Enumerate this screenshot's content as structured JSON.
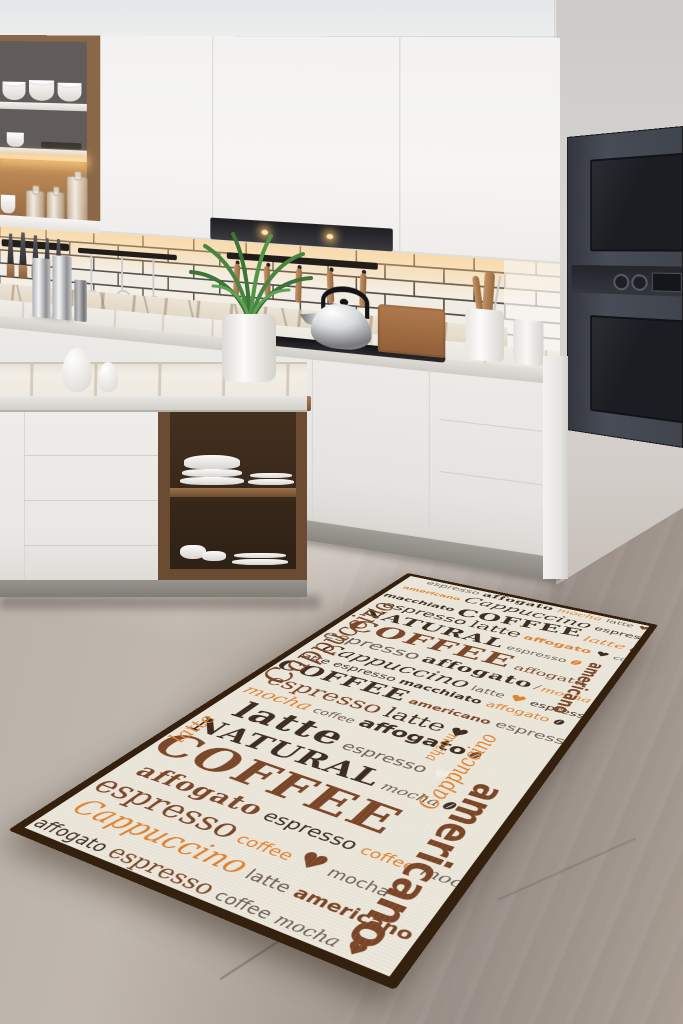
{
  "scene": {
    "type": "kitchen product photo",
    "subject": "coffee-typography kitchen runner rug on concrete floor in modern white kitchen"
  },
  "palette": {
    "wall": "#d5d2cf",
    "cabinet_white": "#f3f2f0",
    "wood": "#8a6747",
    "oven_dark": "#40444d",
    "floor_concrete": "#aaa098",
    "led_glow": "#ffd9a0",
    "rug_bg": "#ece7db",
    "rug_border": "#33200f",
    "rug_dark": "#3a2a1e",
    "rug_brown": "#7a4426",
    "rug_orange": "#e0812f",
    "rug_gray": "#6a5d51",
    "rug_cream": "#f4efe4"
  },
  "rug": {
    "background": "#ece7db",
    "border_color": "#33200f",
    "colors": {
      "d": "#3a2a1e",
      "b": "#7a4426",
      "o": "#e0812f",
      "g": "#6a5d51",
      "w": "#f4efe4"
    },
    "words": [
      "COFFEE",
      "NATURAL",
      "Cappuccino",
      "espresso",
      "latte",
      "mocha",
      "affogato",
      "americano",
      "macchiato",
      "coffee"
    ],
    "icons": {
      "heart": "♥",
      "bean": "coffee-bean-shape"
    },
    "vertical": [
      {
        "w": "Cappuccino",
        "x": -2,
        "y": 96,
        "z": 40,
        "c": "b",
        "f": "f-script",
        "up": true
      },
      {
        "w": "americano",
        "x": 272,
        "y": 128,
        "z": 21,
        "c": "b",
        "f": "f-sansb",
        "up": false
      },
      {
        "w": "mocha",
        "x": 208,
        "y": 338,
        "z": 15,
        "c": "o",
        "f": "f-script",
        "up": false
      },
      {
        "w": "Cappuccino",
        "x": 234,
        "y": 322,
        "z": 22,
        "c": "o",
        "f": "f-script",
        "up": true
      },
      {
        "w": "americano",
        "x": 258,
        "y": 398,
        "z": 36,
        "c": "b",
        "f": "f-sansb",
        "up": false
      },
      {
        "w": "latte",
        "x": 2,
        "y": 420,
        "z": 22,
        "c": "o",
        "f": "f-script",
        "up": true
      }
    ],
    "rows": [
      {
        "pl": 26,
        "t": [
          {
            "w": "espresso",
            "z": 16,
            "c": "g",
            "f": "f-sans"
          },
          {
            "w": "affogato",
            "z": 18,
            "c": "d",
            "f": "f-serifb"
          },
          {
            "w": "mocha",
            "z": 16,
            "c": "o",
            "f": "f-script"
          },
          {
            "w": "latte",
            "z": 14,
            "c": "g",
            "f": "f-sans"
          },
          {
            "i": "heart",
            "z": 14,
            "c": "b"
          },
          {
            "w": "macchiato",
            "z": 13,
            "c": "d",
            "f": "f-sans"
          }
        ]
      },
      {
        "pl": 8,
        "t": [
          {
            "w": "americano",
            "z": 13,
            "c": "o",
            "f": "f-sansb"
          },
          {
            "w": "Cappuccino",
            "z": 26,
            "c": "d",
            "f": "f-script"
          },
          {
            "w": "espresso",
            "z": 16,
            "c": "d",
            "f": "f-sans"
          },
          {
            "w": "latte",
            "z": 14,
            "c": "g",
            "f": "f-sans"
          },
          {
            "i": "bean",
            "z": 14,
            "c": "b"
          }
        ]
      },
      {
        "pl": 0,
        "t": [
          {
            "w": "macchiato",
            "z": 16,
            "c": "d",
            "f": "f-sansb"
          },
          {
            "w": "COFFEE",
            "z": 30,
            "c": "d",
            "f": "f-serifb",
            "r": -6
          },
          {
            "w": "latte",
            "z": 20,
            "c": "o",
            "f": "f-script"
          },
          {
            "w": "affogato",
            "z": 18,
            "c": "b",
            "f": "f-serifb"
          }
        ]
      },
      {
        "pl": 14,
        "t": [
          {
            "w": "espresso",
            "z": 24,
            "c": "d",
            "f": "f-sans"
          },
          {
            "w": "latte",
            "z": 26,
            "c": "d",
            "f": "f-serif"
          },
          {
            "w": "affogato",
            "z": 16,
            "c": "o",
            "f": "f-sansb"
          },
          {
            "i": "heart",
            "z": 16,
            "c": "d"
          },
          {
            "w": "coffee",
            "z": 13,
            "c": "g",
            "f": "f-sans"
          }
        ]
      },
      {
        "pl": 4,
        "t": [
          {
            "w": "NATURAL",
            "z": 30,
            "c": "d",
            "f": "f-serifb"
          },
          {
            "w": "espresso",
            "z": 15,
            "c": "g",
            "f": "f-sans"
          },
          {
            "i": "bean",
            "z": 16,
            "c": "o"
          }
        ]
      },
      {
        "pl": 10,
        "t": [
          {
            "w": "COFFEE",
            "z": 40,
            "c": "b",
            "f": "f-serifb"
          },
          {
            "w": "affogato",
            "z": 18,
            "c": "b",
            "f": "f-serif"
          }
        ]
      },
      {
        "pl": 0,
        "t": [
          {
            "w": "espresso",
            "z": 26,
            "c": "g",
            "f": "f-sans"
          },
          {
            "w": "affogato",
            "z": 24,
            "c": "d",
            "f": "f-serifb"
          },
          {
            "i": "bean",
            "z": 16,
            "c": "b"
          },
          {
            "w": "mocha",
            "z": 15,
            "c": "o",
            "f": "f-script"
          }
        ]
      },
      {
        "pl": 18,
        "t": [
          {
            "w": "Cappuccino",
            "z": 28,
            "c": "d",
            "f": "f-script"
          },
          {
            "w": "latte",
            "z": 15,
            "c": "g",
            "f": "f-sans"
          },
          {
            "i": "heart",
            "z": 18,
            "c": "o"
          },
          {
            "w": "espresso",
            "z": 14,
            "c": "d",
            "f": "f-sans"
          }
        ]
      },
      {
        "pl": 6,
        "t": [
          {
            "w": "latte",
            "z": 16,
            "c": "d",
            "f": "f-sans"
          },
          {
            "w": "espresso",
            "z": 16,
            "c": "d",
            "f": "f-sans"
          },
          {
            "w": "macchiato",
            "z": 15,
            "c": "d",
            "f": "f-sansb"
          },
          {
            "w": "affogato",
            "z": 15,
            "c": "o",
            "f": "f-sans"
          },
          {
            "i": "bean",
            "z": 14,
            "c": "d"
          }
        ]
      },
      {
        "pl": 0,
        "t": [
          {
            "w": "COFFEE",
            "z": 30,
            "c": "d",
            "f": "f-serifb"
          },
          {
            "w": "americano",
            "z": 14,
            "c": "b",
            "f": "f-sansb"
          },
          {
            "w": "espresso",
            "z": 17,
            "c": "g",
            "f": "f-sans"
          }
        ]
      },
      {
        "pl": 12,
        "t": [
          {
            "w": "espresso",
            "z": 28,
            "c": "b",
            "f": "f-serif"
          },
          {
            "w": "latte",
            "z": 26,
            "c": "d",
            "f": "f-serif"
          },
          {
            "i": "heart",
            "z": 20,
            "c": "d"
          }
        ]
      },
      {
        "pl": 4,
        "t": [
          {
            "w": "mocha",
            "z": 22,
            "c": "o",
            "f": "f-script"
          },
          {
            "w": "coffee",
            "z": 14,
            "c": "g",
            "f": "f-sans"
          },
          {
            "w": "affogato",
            "z": 22,
            "c": "d",
            "f": "f-sansb"
          },
          {
            "i": "bean",
            "z": 15,
            "c": "b"
          }
        ]
      },
      {
        "pl": 22,
        "t": [
          {
            "w": "latte",
            "z": 40,
            "c": "d",
            "f": "f-serifb"
          },
          {
            "w": "espresso",
            "z": 18,
            "c": "g",
            "f": "f-sans"
          },
          {
            "i": "heart",
            "z": 18,
            "c": "w"
          }
        ]
      },
      {
        "pl": 6,
        "t": [
          {
            "w": "NATURAL",
            "z": 32,
            "c": "d",
            "f": "f-serifb"
          },
          {
            "w": "mocha",
            "z": 15,
            "c": "g",
            "f": "f-script"
          },
          {
            "i": "bean",
            "z": 15,
            "c": "d"
          }
        ]
      },
      {
        "pl": 0,
        "t": [
          {
            "w": "COFFEE",
            "z": 48,
            "c": "b",
            "f": "f-serifb",
            "r": 2
          }
        ]
      },
      {
        "pl": 16,
        "t": [
          {
            "w": "affogato",
            "z": 24,
            "c": "b",
            "f": "f-serifb"
          },
          {
            "w": "espresso",
            "z": 18,
            "c": "d",
            "f": "f-sans"
          },
          {
            "w": "coffee",
            "z": 14,
            "c": "o",
            "f": "f-sans"
          },
          {
            "w": "mocha",
            "z": 15,
            "c": "g",
            "f": "f-script"
          }
        ]
      },
      {
        "pl": 2,
        "t": [
          {
            "w": "espresso",
            "z": 30,
            "c": "b",
            "f": "f-serif"
          },
          {
            "w": "coffee",
            "z": 15,
            "c": "o",
            "f": "f-sans"
          },
          {
            "i": "heart",
            "z": 24,
            "c": "b"
          },
          {
            "w": "mocha",
            "z": 14,
            "c": "g",
            "f": "f-sans"
          }
        ]
      },
      {
        "pl": 10,
        "t": [
          {
            "w": "Cappuccino",
            "z": 26,
            "c": "o",
            "f": "f-script"
          },
          {
            "w": "latte",
            "z": 15,
            "c": "g",
            "f": "f-sans"
          },
          {
            "w": "americano",
            "z": 15,
            "c": "b",
            "f": "f-sansb"
          },
          {
            "i": "bean",
            "z": 15,
            "c": "d"
          }
        ]
      },
      {
        "pl": 0,
        "t": [
          {
            "w": "affogato",
            "z": 16,
            "c": "d",
            "f": "f-sans"
          },
          {
            "w": "espresso",
            "z": 20,
            "c": "b",
            "f": "f-serif"
          },
          {
            "w": "coffee",
            "z": 14,
            "c": "g",
            "f": "f-sans"
          },
          {
            "w": "mocha",
            "z": 14,
            "c": "g",
            "f": "f-script"
          },
          {
            "i": "heart",
            "z": 16,
            "c": "b"
          }
        ]
      }
    ]
  }
}
